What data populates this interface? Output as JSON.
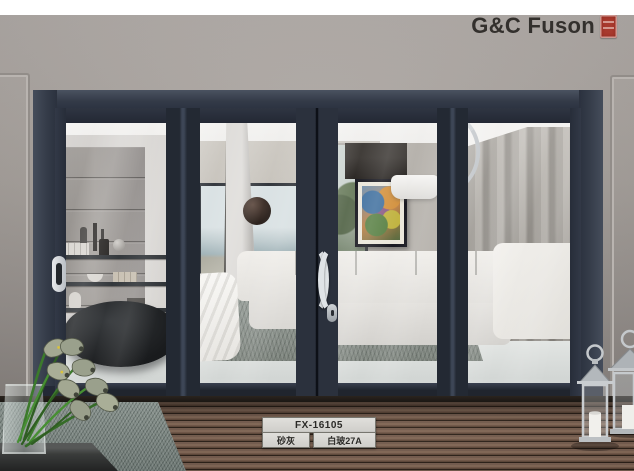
{
  "brand": {
    "logo_text": "G&C Fuson",
    "seal_icon": "red-chinese-seal"
  },
  "product_plate": {
    "model": "FX-16105",
    "finish_label": "砂灰",
    "glass_label": "白玻27A"
  },
  "colors": {
    "door_frame": "#343b49",
    "wall": "#a7a19c",
    "seal_red": "#a83a2e",
    "deck_wood": "#5f4b3e",
    "plate_bg": "#d9d8d4"
  }
}
